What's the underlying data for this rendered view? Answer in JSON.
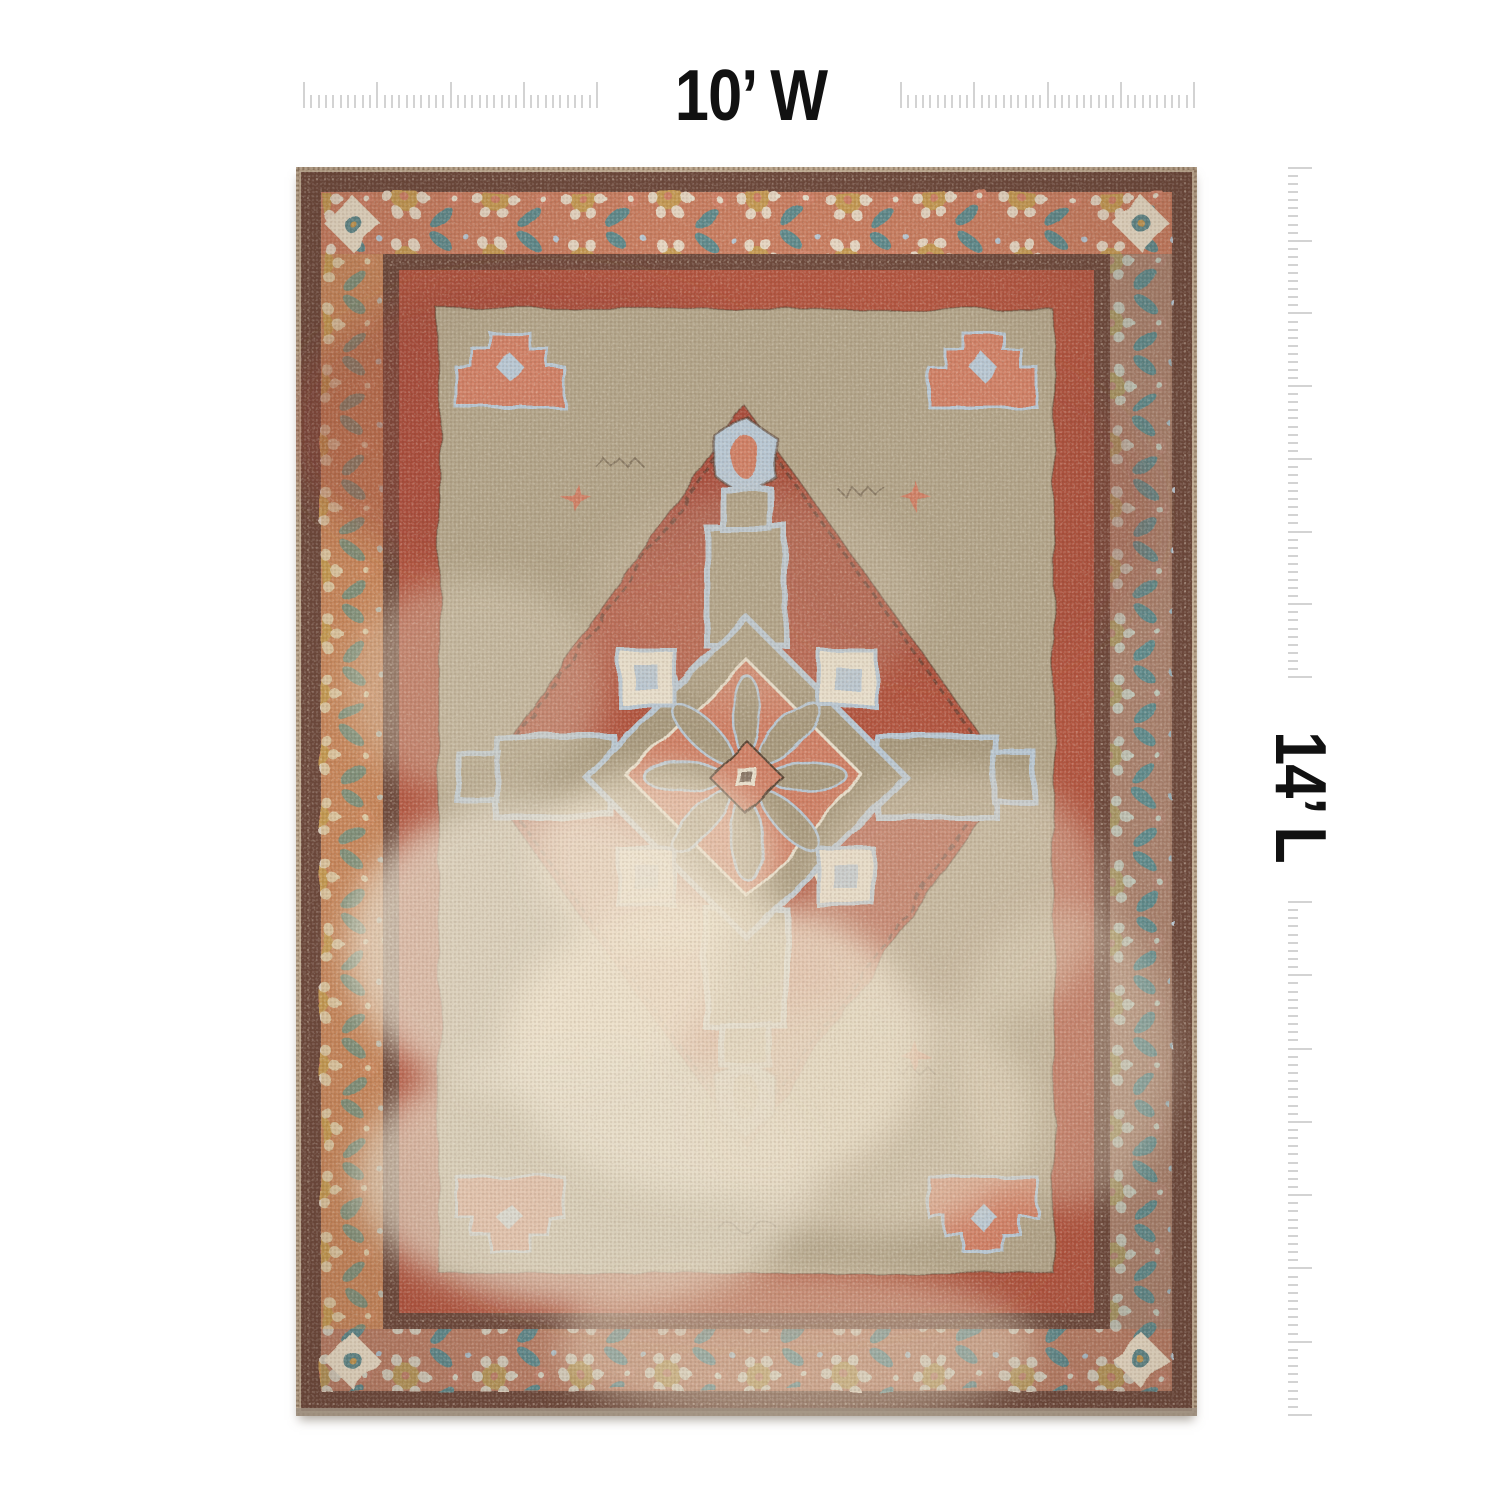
{
  "page": {
    "background_color": "#ffffff"
  },
  "annotations": {
    "width_label": "10’ W",
    "length_label": "14’ L",
    "label_color": "#111111",
    "ruler_tick_color": "#d3d3d3"
  },
  "product_image": {
    "name": "vintage-medallion-area-rug",
    "alt": "Distressed vintage-style medallion area rug in terracotta red, taupe, coral and teal with ornate floral borders",
    "palette": {
      "selvage": "#c2ae94",
      "guard_maroon": "#6e4a3d",
      "border_salmon": "#c87d60",
      "border_gold": "#c59a52",
      "border_teal": "#5f8a8c",
      "border_ivory": "#e8dcc6",
      "field_red": "#b25641",
      "field_dark_red": "#9a4734",
      "spandrel_taupe": "#b2a489",
      "medallion_taupe": "#a89a7e",
      "medallion_blue": "#b7c6d2",
      "coral": "#cf8066",
      "cream": "#e7decb",
      "outline_brown": "#5a4535",
      "edge_shadow": "#9f9181"
    }
  }
}
